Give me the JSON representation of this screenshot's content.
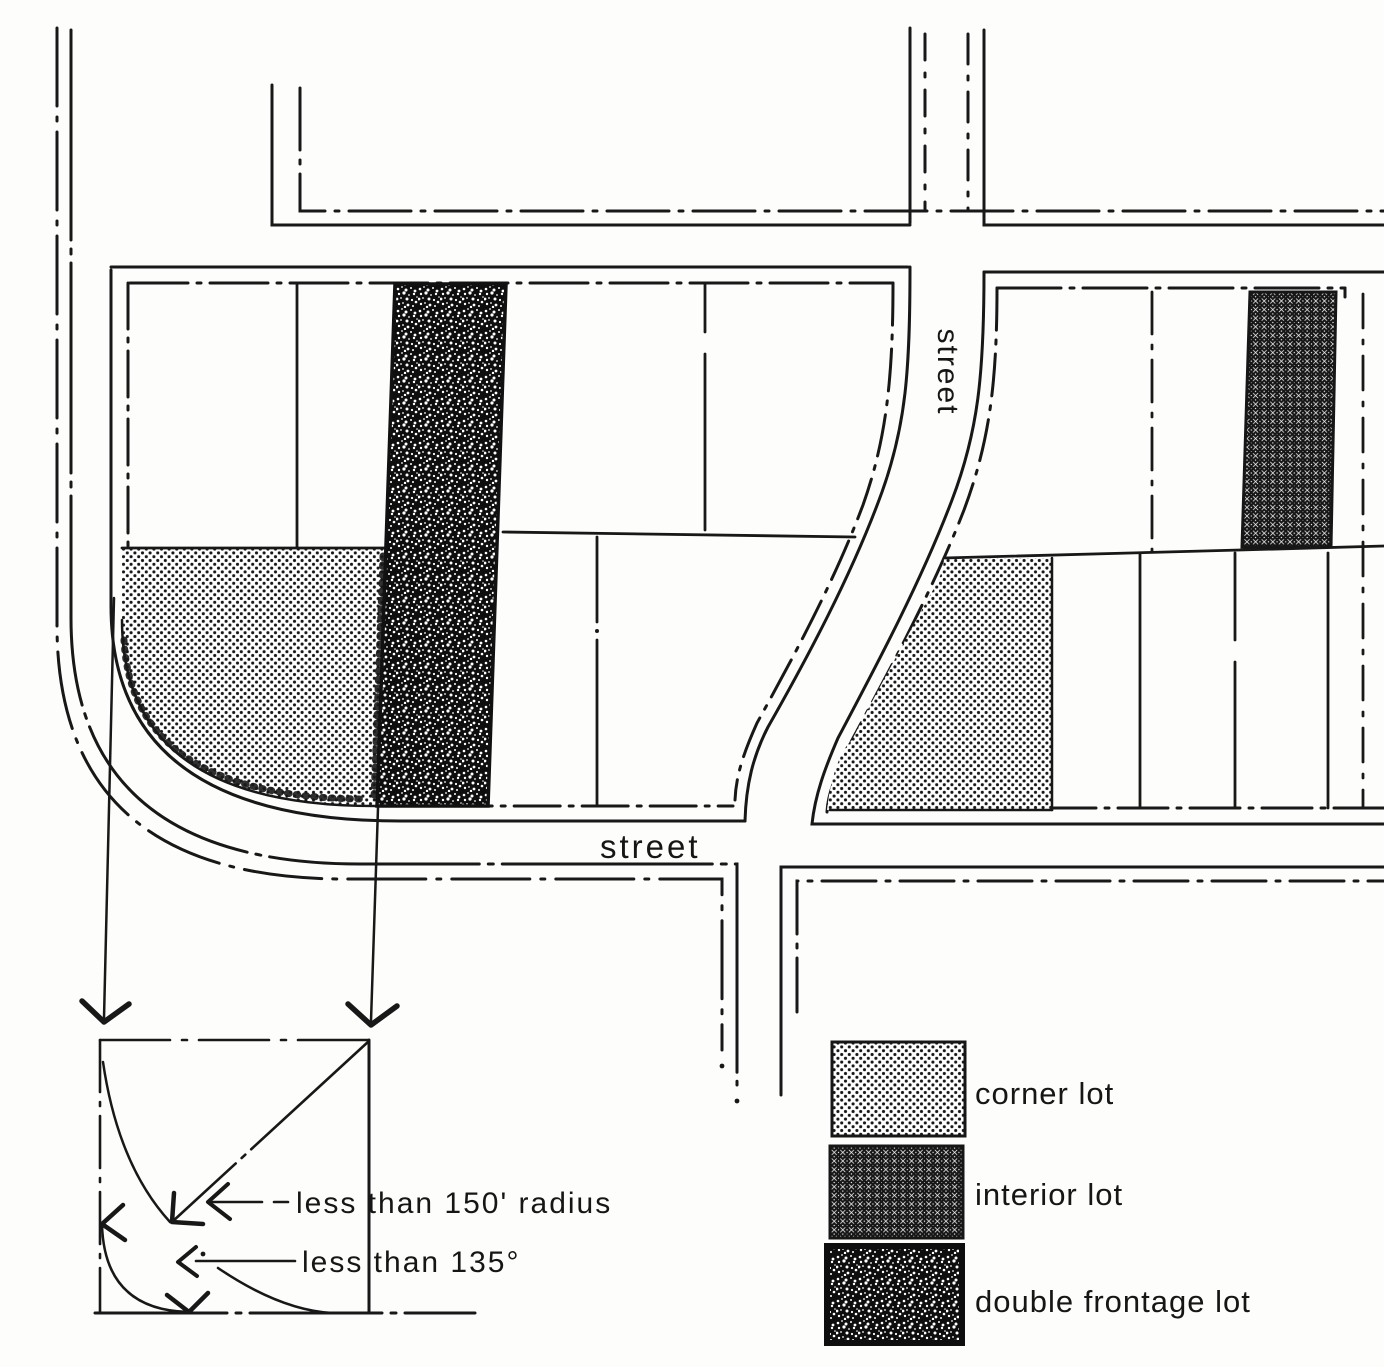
{
  "figure": {
    "title_implicit": "lot types plat diagram",
    "street_label_horizontal": "street",
    "street_label_vertical": "street",
    "detail": {
      "annotation_radius": "less than 150' radius",
      "annotation_angle": "less than 135°"
    },
    "legend": {
      "items": [
        {
          "label": "corner lot",
          "pattern": "dots"
        },
        {
          "label": "interior lot",
          "pattern": "crosshatch"
        },
        {
          "label": "double frontage lot",
          "pattern": "speckle"
        }
      ]
    },
    "colors": {
      "ink": "#181818",
      "paper": "#fdfdfb"
    }
  }
}
